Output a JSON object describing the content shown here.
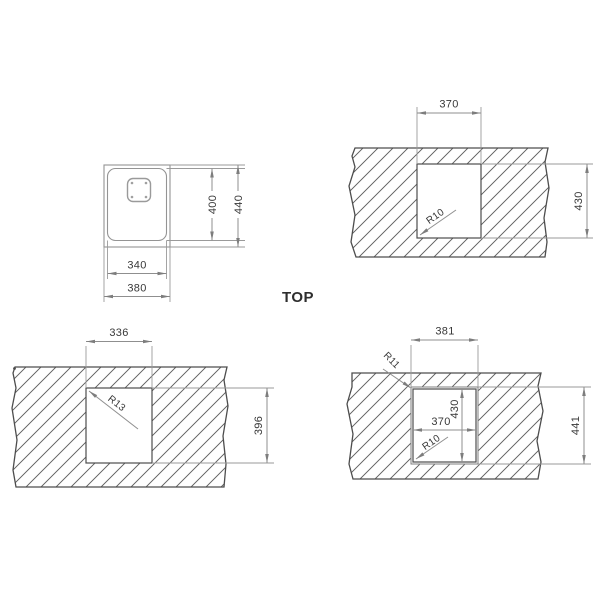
{
  "title_label": "TOP",
  "colors": {
    "background": "#ffffff",
    "drawing_line": "#949494",
    "cutout_outline": "#4d4d4d",
    "hatch_line": "#707070",
    "dimension_text": "#383838"
  },
  "panels": {
    "sink_outline": {
      "bowl_width": "340",
      "flange_width": "380",
      "bowl_height": "400",
      "flange_height": "440"
    },
    "cutout_top_right": {
      "cutout_width": "370",
      "cutout_height": "430",
      "corner_radius": "R10"
    },
    "cutout_bottom_left": {
      "cutout_width": "336",
      "cutout_height": "396",
      "corner_radius": "R13"
    },
    "cutout_bottom_right": {
      "flange_width": "381",
      "flange_height": "441",
      "cutout_width": "370",
      "cutout_height": "430",
      "flange_radius": "R11",
      "cutout_radius": "R10"
    }
  }
}
